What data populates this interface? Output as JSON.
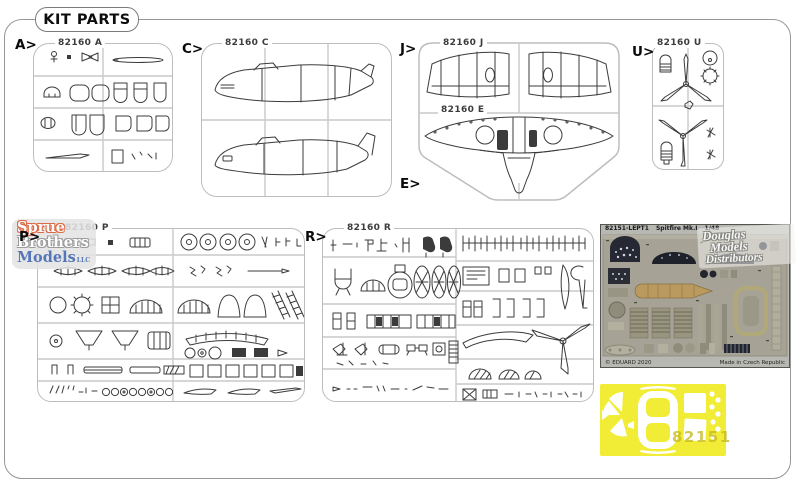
{
  "page": {
    "title": "KIT PARTS"
  },
  "sprues": {
    "A": {
      "arrow": "A>",
      "code": "82160 A"
    },
    "C": {
      "arrow": "C>",
      "code": "82160 C"
    },
    "J": {
      "arrow": "J>",
      "code": "82160 J"
    },
    "E": {
      "arrow": "E>",
      "code": "82160 E"
    },
    "U": {
      "arrow": "U>",
      "code": "82160 U"
    },
    "P": {
      "arrow": "P>",
      "code": "82160 P"
    },
    "R": {
      "arrow": "R>",
      "code": "82160 R"
    }
  },
  "pe_fret": {
    "part_number": "82151-LEPT1",
    "kit_name": "Spitfire Mk.I",
    "scale": "1/48",
    "copyright": "© EDUARD 2020",
    "made_in": "Made in Czech Republic"
  },
  "mask_sheet": {
    "number": "82151"
  },
  "watermark": {
    "word1": "Sprue",
    "word2": "Brothers",
    "word3": "Models",
    "suffix": "LLC"
  },
  "stamp": {
    "line1": "Douglas",
    "line2": "Models",
    "line3": "Distributors"
  },
  "colors": {
    "mask_yellow": "#f1ec35",
    "pe_fret_base": "#a6a396",
    "frame_gray": "#bdbdbd"
  }
}
